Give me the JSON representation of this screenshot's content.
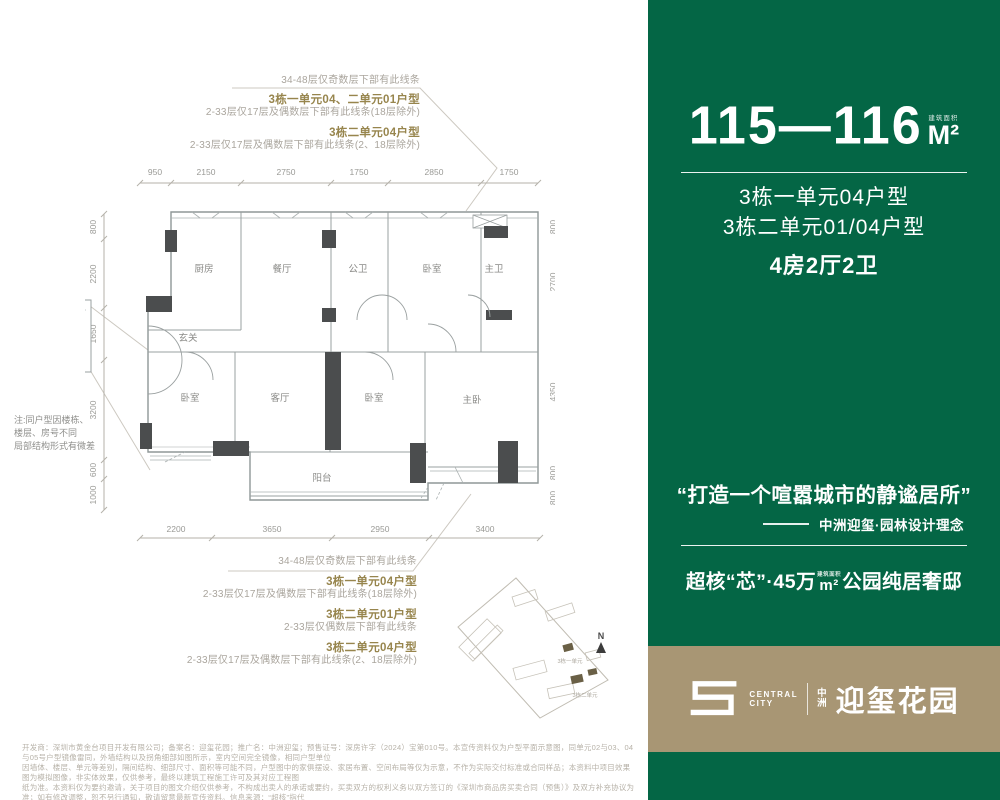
{
  "colors": {
    "panel_green": "#046645",
    "logo_tan": "#a89674",
    "annotation_olive": "#97854d",
    "annotation_gray": "#aaa59d",
    "wall_dark": "#4b4d4e",
    "plan_line": "#98a0a0"
  },
  "floorplan": {
    "dims": {
      "top": [
        "950",
        "2150",
        "2750",
        "1750",
        "2850",
        "1750"
      ],
      "bottom": [
        "2200",
        "3650",
        "2950",
        "3400"
      ],
      "left": [
        "800",
        "2200",
        "1650",
        "3200",
        "600",
        "1000"
      ],
      "right": [
        "800",
        "2700",
        "4350",
        "800",
        "800"
      ]
    },
    "rooms": [
      "厨房",
      "餐厅",
      "公卫",
      "卧室",
      "主卫",
      "玄关",
      "卧室",
      "客厅",
      "卧室",
      "主卧",
      "阳台"
    ],
    "note_lines": [
      "注:同户型因楼栋、",
      "楼层、房号不同",
      "局部结构形式有微差"
    ],
    "annotations_top": {
      "l1": "34-48层仅奇数层下部有此线条",
      "b1": "3栋一单元04、二单元01户型",
      "l2": "2-33层仅17层及偶数层下部有此线条(18层除外)",
      "b2": "3栋二单元04户型",
      "l3": "2-33层仅17层及偶数层下部有此线条(2、18层除外)"
    },
    "annotations_bottom": {
      "l1": "34-48层仅奇数层下部有此线条",
      "b1": "3栋一单元04户型",
      "l2": "2-33层仅17层及偶数层下部有此线条(18层除外)",
      "b2": "3栋二单元01户型",
      "l3": "2-33层仅偶数层下部有此线条",
      "b3": "3栋二单元04户型",
      "l4": "2-33层仅17层及偶数层下部有此线条(2、18层除外)"
    }
  },
  "sitemap": {
    "north": "N",
    "label1": "3栋一单元",
    "label2": "3栋二单元"
  },
  "panel": {
    "area_range": "115—116",
    "area_unit": "M²",
    "area_note": "建筑面积",
    "unit_line1": "3栋一单元04户型",
    "unit_line2": "3栋二单元01/04户型",
    "layout": "4房2厅2卫",
    "quote": "“打造一个喧嚣城市的静谧居所”",
    "quote_source": "中洲迎玺·园林设计理念",
    "slogan_pre": "超核“芯”·45万",
    "slogan_unit": "m²",
    "slogan_unit_note": "建筑面积",
    "slogan_post": "公园纯居奢邸",
    "logo_en1": "CENTRAL",
    "logo_en2": "CITY",
    "logo_cn_small1": "中",
    "logo_cn_small2": "洲",
    "logo_cn_big": "迎玺花园"
  },
  "disclaimer": {
    "lines": [
      "开发商：深圳市黄金台项目开发有限公司；备案名：迎玺花园；推广名：中洲迎玺；预售证号：深房许字（2024）宝第010号。本宣传资料仅为户型平面示意图，同单元02与03、04与05号户型镜像雷同，外墙结构以及拐角细部如图所示，室内空间完全镜像，相同户型单位",
      "因墙体、楼层、单元等差别，隔间结构、细部尺寸、面积等可能不同，户型图中的家俱摆设、家居布置、空间布局等仅为示意，不作为实际交付标准或合同样品；本资料中项目效果图为模拟图像，非实体效果，仅供参考，最终以建筑工程施工许可及其对应工程图",
      "纸为准。本资料仅为要约邀请，关于项目的图文介绍仅供参考，不构成出卖人的承诺或要约，买卖双方的权利义务以双方签订的《深圳市商品房买卖合同（预售）》及双方补充协议为准；如有修改调整，恕不另行通知，敬请留意最新宣传资料。信息来源：“超核”指代",
      "政府规划的“城市超核”，该规划来源于深圳市规划和自然资源局公众号《深圳北站枢纽地区城市设计国际咨询整合深化成果重磅出炉》。发布日期2023年12月24日；制作时间：2025年01月。"
    ]
  }
}
